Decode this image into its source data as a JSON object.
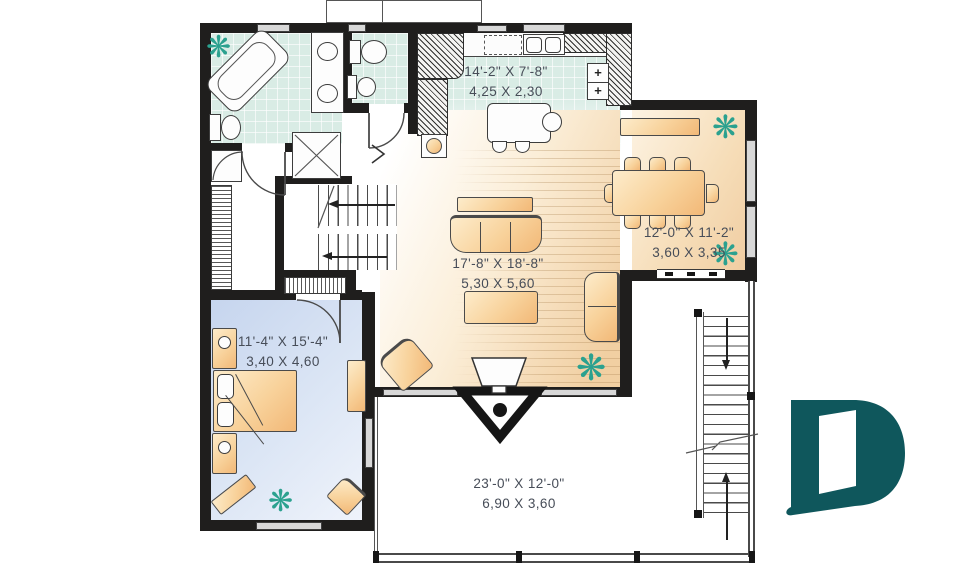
{
  "title": "second-floor-plan",
  "rooms": {
    "kitchen": {
      "imperial": "14'-2\" X 7'-8\"",
      "metric": "4,25 X 2,30"
    },
    "dining": {
      "imperial": "12'-0\" X 11'-2\"",
      "metric": "3,60 X 3,35"
    },
    "living": {
      "imperial": "17'-8\" X 18'-8\"",
      "metric": "5,30 X 5,60"
    },
    "bedroom": {
      "imperial": "11'-4\" X 15'-4\"",
      "metric": "3,40 X 4,60"
    },
    "deck": {
      "imperial": "23'-0\" X 12'-0\"",
      "metric": "6,90 X 3,60"
    }
  },
  "watermark": {
    "letter": "D",
    "color": "#0f575c"
  },
  "icons": {
    "plant": "❋",
    "range_burner": "+"
  },
  "colors": {
    "wall": "#1f1e1d",
    "tile_floor": "#d9ece5",
    "wood_floor": "#f1cfa2",
    "bedroom_floor": "#c9d7ee",
    "furniture": "#f4bd7d",
    "plant": "#2ba18f",
    "dimension_text": "#474d58"
  }
}
